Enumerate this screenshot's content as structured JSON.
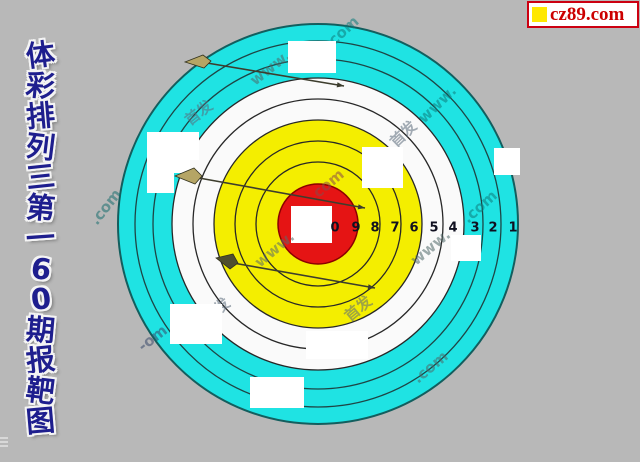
{
  "page": {
    "width": 640,
    "height": 462,
    "background": "#b8b8b8"
  },
  "sidebar_title": {
    "text": "体彩排列三第160期报靶图",
    "chars": [
      "体",
      "彩",
      "排",
      "列",
      "三",
      "第",
      "一",
      "6",
      "0",
      "期",
      "报",
      "靶",
      "图"
    ],
    "color": "#1e1e8e"
  },
  "logo": {
    "label": "cz89.com",
    "text_color": "#cc0000",
    "border_color": "#cc0011",
    "background": "#ffffff",
    "square_color": "#ffe800"
  },
  "target": {
    "center": {
      "x": 318,
      "y": 224
    },
    "colors": {
      "cyan": "#1fe3e3",
      "white_band": "#fafafa",
      "yellow": "#f4ee00",
      "red": "#e51414",
      "ring_line": "#272727",
      "outer_edge": "#135e5e",
      "number": "#101020"
    },
    "rings": [
      {
        "name": "outer-cyan",
        "r": 200,
        "fill": "#1fe3e3",
        "stroke": "#135e5e",
        "sw": 2
      },
      {
        "name": "cyan-line-1",
        "r": 183,
        "fill": "none",
        "stroke": "#1e4545",
        "sw": 1.3
      },
      {
        "name": "cyan-line-2",
        "r": 165,
        "fill": "none",
        "stroke": "#1e4545",
        "sw": 1.3
      },
      {
        "name": "white-band",
        "r": 146,
        "fill": "#fafafa",
        "stroke": "#272727",
        "sw": 1.3
      },
      {
        "name": "white-line",
        "r": 125,
        "fill": "none",
        "stroke": "#272727",
        "sw": 1.3
      },
      {
        "name": "yellow-band",
        "r": 104,
        "fill": "#f4ee00",
        "stroke": "#272727",
        "sw": 1.3
      },
      {
        "name": "yellow-line-1",
        "r": 83,
        "fill": "none",
        "stroke": "#272727",
        "sw": 1.3
      },
      {
        "name": "yellow-line-2",
        "r": 62,
        "fill": "none",
        "stroke": "#272727",
        "sw": 1.3
      },
      {
        "name": "bullseye-red",
        "r": 40,
        "fill": "#e51414",
        "stroke": "#8b0000",
        "sw": 1.5
      }
    ],
    "bullseye_square": {
      "x": 291,
      "y": 206,
      "w": 41,
      "h": 37,
      "fill": "#ffffff"
    },
    "ring_numbers": {
      "y": 228,
      "labels": [
        {
          "t": "0",
          "x": 335
        },
        {
          "t": "9",
          "x": 356
        },
        {
          "t": "8",
          "x": 375
        },
        {
          "t": "7",
          "x": 395
        },
        {
          "t": "6",
          "x": 414
        },
        {
          "t": "5",
          "x": 434
        },
        {
          "t": "4",
          "x": 453
        },
        {
          "t": "3",
          "x": 475
        },
        {
          "t": "2",
          "x": 493
        },
        {
          "t": "1",
          "x": 513
        }
      ]
    },
    "markers": [
      {
        "x": 288,
        "y": 41,
        "w": 48,
        "h": 32
      },
      {
        "x": 362,
        "y": 147,
        "w": 41,
        "h": 41
      },
      {
        "x": 147,
        "y": 132,
        "w": 52,
        "h": 28
      },
      {
        "x": 147,
        "y": 157,
        "w": 27,
        "h": 36
      },
      {
        "x": 171,
        "y": 156,
        "w": 19,
        "h": 17
      },
      {
        "x": 451,
        "y": 235,
        "w": 30,
        "h": 26
      },
      {
        "x": 170,
        "y": 304,
        "w": 52,
        "h": 40
      },
      {
        "x": 306,
        "y": 331,
        "w": 62,
        "h": 28
      },
      {
        "x": 250,
        "y": 377,
        "w": 54,
        "h": 31
      },
      {
        "x": 494,
        "y": 148,
        "w": 26,
        "h": 27
      }
    ],
    "darts": [
      {
        "head": "185,62 203,55 211,61 204,68",
        "head_fill": "#b5a565",
        "line": [
          207,
          63,
          344,
          86
        ]
      },
      {
        "head": "175,176 194,168 202,176 195,184",
        "head_fill": "#b5a565",
        "line": [
          199,
          178,
          365,
          208
        ]
      },
      {
        "head": "216,258 233,254 238,263 230,269",
        "head_fill": "#4f4f2f",
        "line": [
          233,
          263,
          375,
          288
        ]
      }
    ],
    "dart_line_color": "#3d3d2d",
    "watermarks": [
      {
        "t": "www.",
        "x": 255,
        "y": 86,
        "r": -38,
        "c": "#4f6868"
      },
      {
        "t": "首发",
        "x": 190,
        "y": 126,
        "r": -38,
        "c": "#5a6a7a"
      },
      {
        "t": ".com",
        "x": 97,
        "y": 226,
        "r": -52,
        "c": "#1a6e6e"
      },
      {
        "t": "www.",
        "x": 424,
        "y": 124,
        "r": -44,
        "c": "#0f7d7d"
      },
      {
        "t": "首发",
        "x": 396,
        "y": 148,
        "r": -44,
        "c": "#5a6a7a"
      },
      {
        "t": "com",
        "x": 334,
        "y": 46,
        "r": -42,
        "c": "#0f7d7d"
      },
      {
        "t": ".com",
        "x": 468,
        "y": 224,
        "r": -42,
        "c": "#0f7d7d"
      },
      {
        "t": "www.",
        "x": 260,
        "y": 268,
        "r": -40,
        "c": "#5a6a6a"
      },
      {
        "t": ".com",
        "x": 314,
        "y": 202,
        "r": -40,
        "c": "#8a4a4a"
      },
      {
        "t": "www.",
        "x": 416,
        "y": 266,
        "r": -40,
        "c": "#4f6868"
      },
      {
        "t": "首发",
        "x": 208,
        "y": 324,
        "r": -40,
        "c": "#5a6a7a"
      },
      {
        "t": "首发",
        "x": 350,
        "y": 322,
        "r": -40,
        "c": "#5a6a7a"
      },
      {
        "t": "-om",
        "x": 143,
        "y": 352,
        "r": -38,
        "c": "#3a4a6a"
      },
      {
        "t": ".com",
        "x": 418,
        "y": 384,
        "r": -40,
        "c": "#4f6868"
      }
    ]
  }
}
